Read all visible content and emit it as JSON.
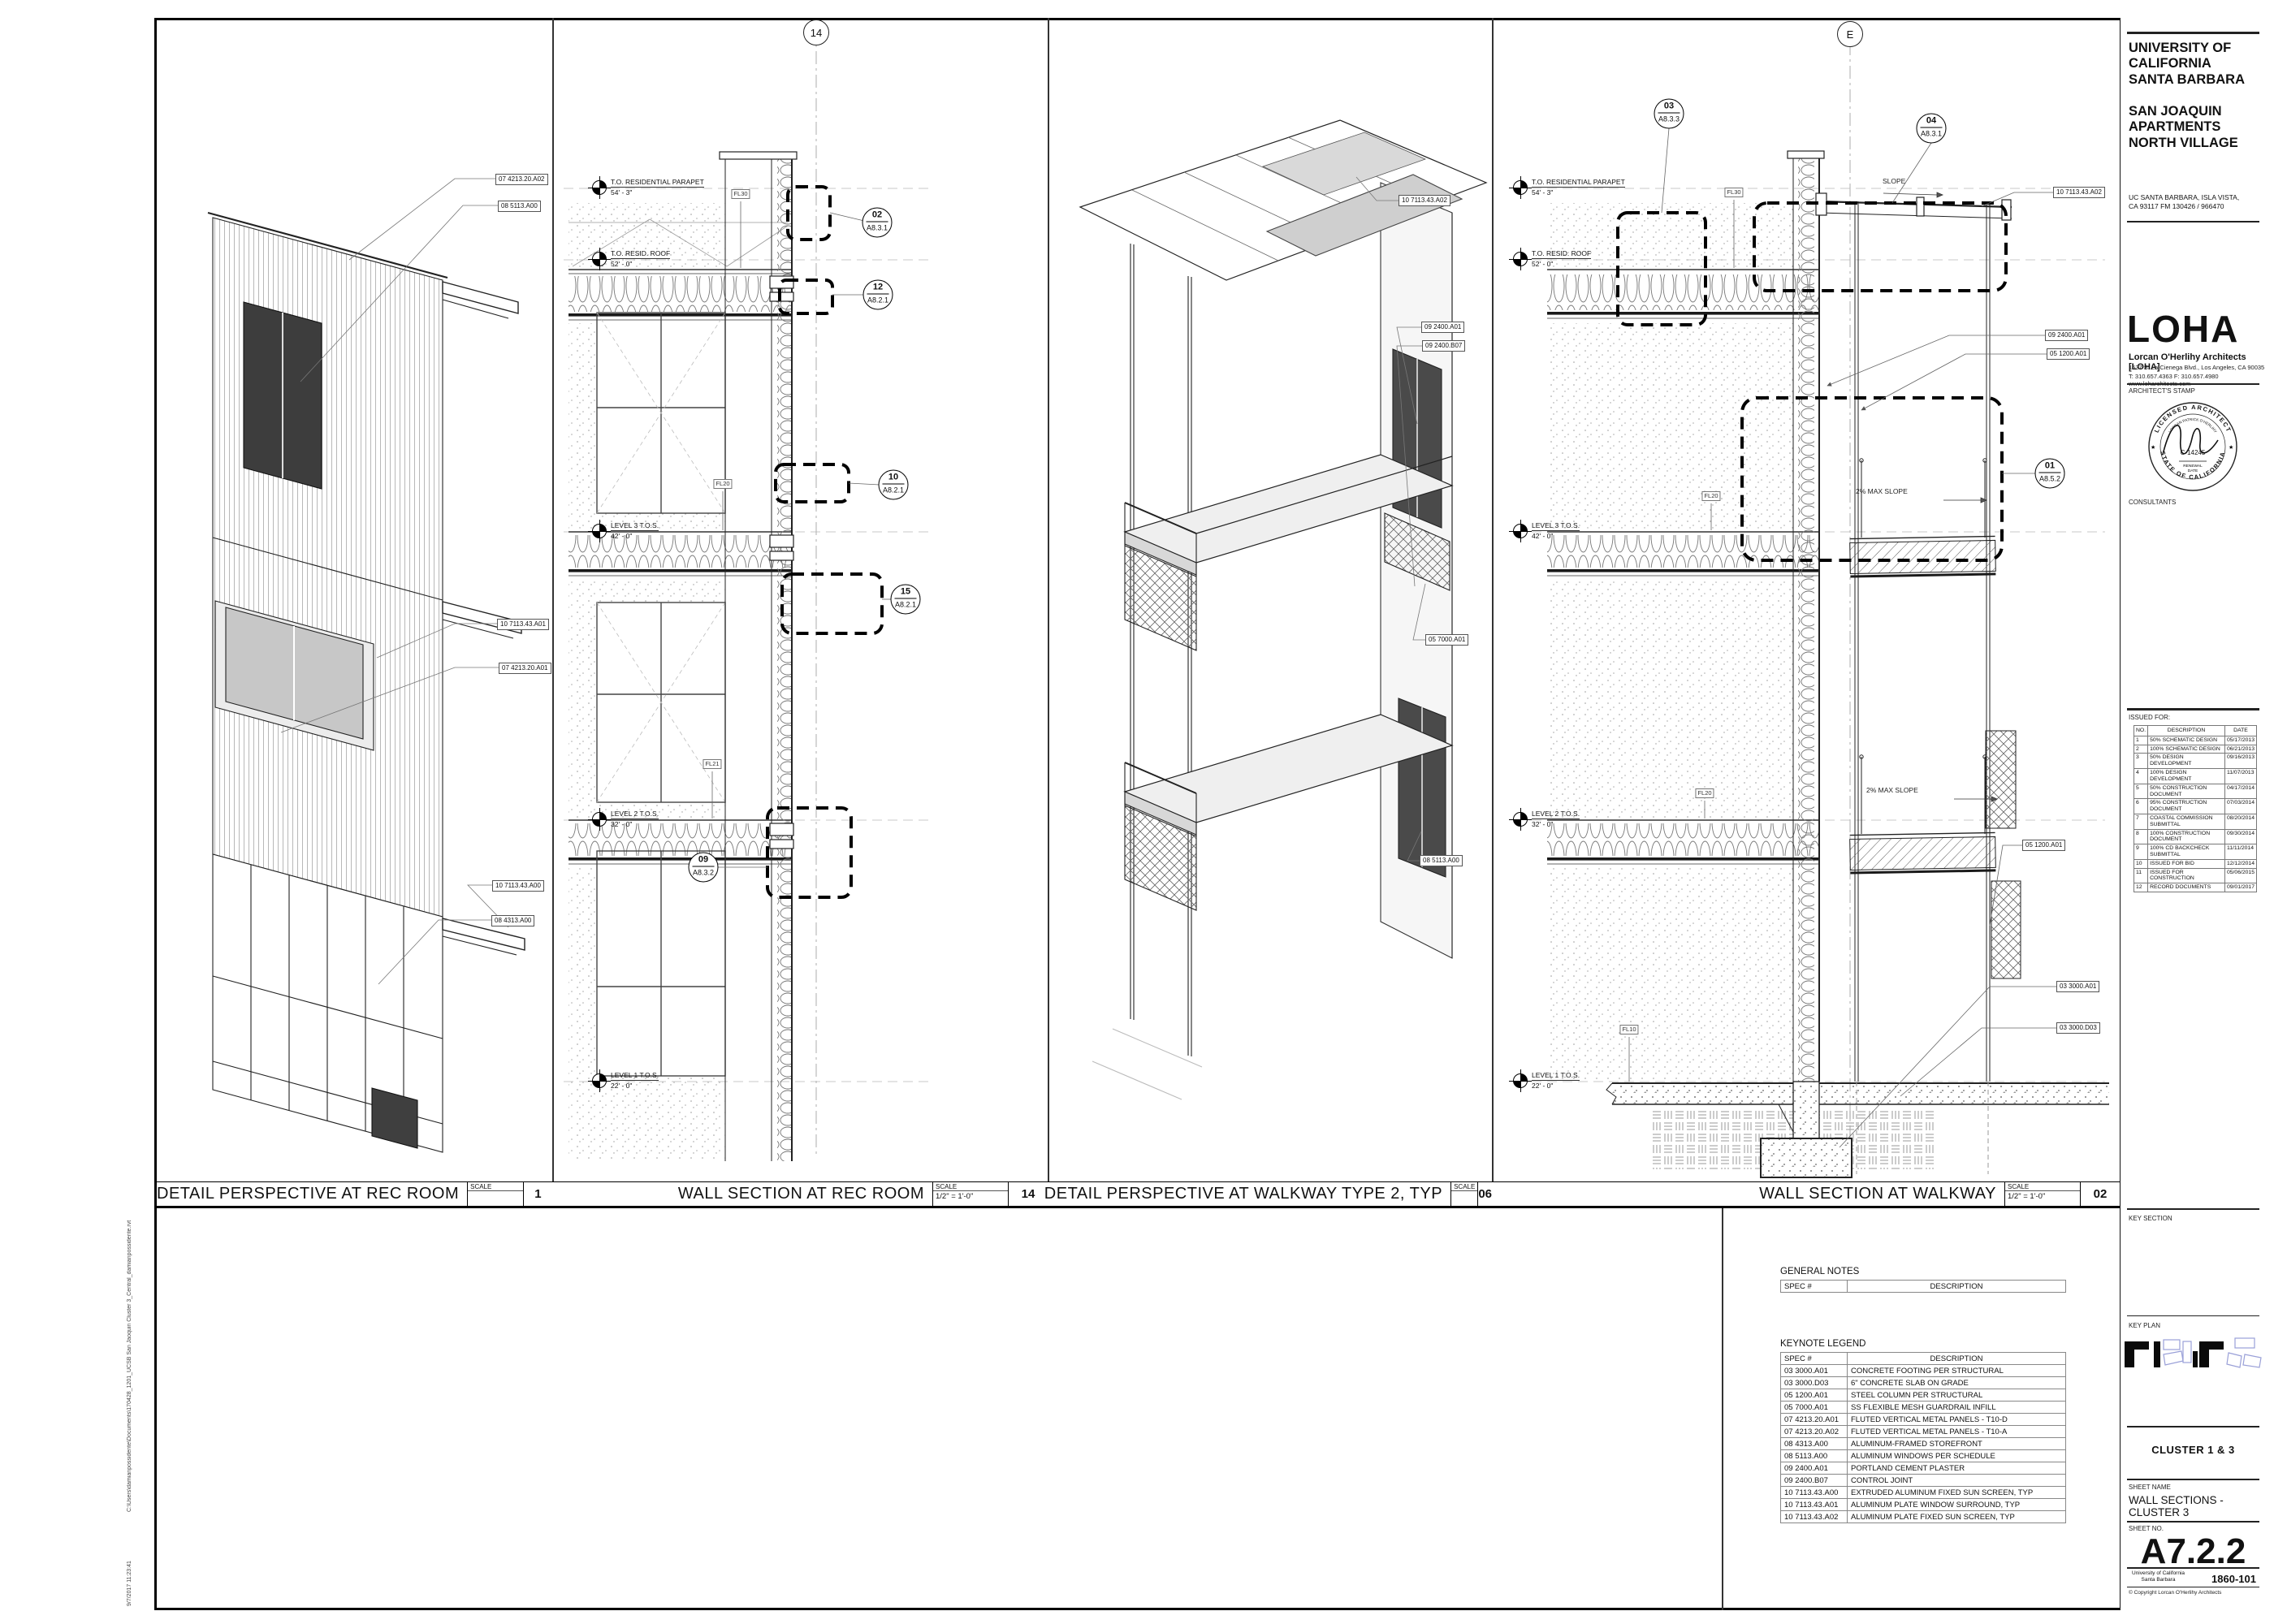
{
  "margin": {
    "path": "C:\\Users\\damianpossidente\\Documents\\170428_1201_UCSB San Jaoquin Cluster 3_Central_damianpossidente.rvt",
    "datetime": "9/7/2017 11:23:41"
  },
  "panels": {
    "p1": {
      "title": "DETAIL PERSPECTIVE  AT REC ROOM",
      "scale_label": "SCALE",
      "scale": "",
      "num": "1",
      "tags": [
        "07 4213.20.A02",
        "08 5113.A00",
        "10 7113.43.A01",
        "07 4213.20.A01",
        "10 7113.43.A00",
        "08 4313.A00"
      ]
    },
    "p2": {
      "title": "WALL SECTION AT REC ROOM",
      "scale_label": "SCALE",
      "scale": "1/2\" = 1'-0\"",
      "num": "14",
      "grid": "14",
      "levels": [
        {
          "name": "T.O. RESIDENTIAL PARAPET",
          "elev": "54' - 3\""
        },
        {
          "name": "T.O. RESID. ROOF",
          "elev": "52' - 0\""
        },
        {
          "name": "LEVEL 3 T.O.S.",
          "elev": "42' - 0\""
        },
        {
          "name": "LEVEL 2 T.O.S.",
          "elev": "32' - 0\""
        },
        {
          "name": "LEVEL 1 T.O.S.",
          "elev": "22' - 0\""
        }
      ],
      "callouts": [
        {
          "num": "02",
          "sht": "A8.3.1"
        },
        {
          "num": "12",
          "sht": "A8.2.1"
        },
        {
          "num": "10",
          "sht": "A8.2.1"
        },
        {
          "num": "15",
          "sht": "A8.2.1"
        },
        {
          "num": "09",
          "sht": "A8.3.2"
        }
      ],
      "fl": [
        "FL30",
        "FL20",
        "FL21"
      ]
    },
    "p3": {
      "title": "DETAIL PERSPECTIVE  AT WALKWAY TYPE 2, TYP",
      "scale_label": "SCALE",
      "scale": "",
      "num": "06",
      "tags": [
        "10 7113.43.A02",
        "09 2400.A01",
        "09 2400.B07",
        "05 7000.A01",
        "08 5113.A00"
      ]
    },
    "p4": {
      "title": "WALL SECTION AT WALKWAY",
      "scale_label": "SCALE",
      "scale": "1/2\" = 1'-0\"",
      "num": "02",
      "grid": "E",
      "levels": [
        {
          "name": "T.O. RESIDENTIAL PARAPET",
          "elev": "54' - 3\""
        },
        {
          "name": "T.O. RESID. ROOF",
          "elev": "52' - 0\""
        },
        {
          "name": "LEVEL 3 T.O.S.",
          "elev": "42' - 0\""
        },
        {
          "name": "LEVEL 2 T.O.S.",
          "elev": "32' - 0\""
        },
        {
          "name": "LEVEL 1 T.O.S.",
          "elev": "22' - 0\""
        }
      ],
      "callouts": [
        {
          "num": "03",
          "sht": "A8.3.3"
        },
        {
          "num": "04",
          "sht": "A8.3.1"
        },
        {
          "num": "01",
          "sht": "A8.5.2"
        }
      ],
      "tags": [
        "10 7113.43.A02",
        "09 2400.A01",
        "05 1200.A01",
        "05 1200.A01",
        "03 3000.A01",
        "03 3000.D03"
      ],
      "slopes": [
        "SLOPE",
        "2% MAX SLOPE",
        "2% MAX SLOPE"
      ],
      "fl": [
        "FL30",
        "FL20",
        "FL20",
        "FL10"
      ]
    }
  },
  "notes": {
    "general_label": "GENERAL NOTES",
    "keynote_label": "KEYNOTE LEGEND",
    "col_spec": "SPEC #",
    "col_desc": "DESCRIPTION",
    "keynotes": [
      [
        "03 3000.A01",
        "CONCRETE FOOTING PER STRUCTURAL"
      ],
      [
        "03 3000.D03",
        "6\" CONCRETE SLAB ON GRADE"
      ],
      [
        "05 1200.A01",
        "STEEL COLUMN PER STRUCTURAL"
      ],
      [
        "05 7000.A01",
        "SS FLEXIBLE MESH GUARDRAIL INFILL"
      ],
      [
        "07 4213.20.A01",
        "FLUTED VERTICAL METAL PANELS - T10-D"
      ],
      [
        "07 4213.20.A02",
        "FLUTED VERTICAL METAL PANELS - T10-A"
      ],
      [
        "08 4313.A00",
        "ALUMINUM-FRAMED STOREFRONT"
      ],
      [
        "08 5113.A00",
        "ALUMINUM WINDOWS PER SCHEDULE"
      ],
      [
        "09 2400.A01",
        "PORTLAND CEMENT PLASTER"
      ],
      [
        "09 2400.B07",
        "CONTROL JOINT"
      ],
      [
        "10 7113.43.A00",
        "EXTRUDED ALUMINUM FIXED SUN SCREEN, TYP"
      ],
      [
        "10 7113.43.A01",
        "ALUMINUM PLATE WINDOW SURROUND, TYP"
      ],
      [
        "10 7113.43.A02",
        "ALUMINUM PLATE FIXED SUN SCREEN, TYP"
      ]
    ]
  },
  "titleblock": {
    "client": "UNIVERSITY OF\nCALIFORNIA\nSANTA BARBARA",
    "project": "SAN JOAQUIN\nAPARTMENTS\nNORTH VILLAGE",
    "address": "UC SANTA BARBARA, ISLA VISTA,\nCA 93117 FM 130426 / 966470",
    "logo": "LOHA",
    "firm": "Lorcan O'Herlihy Architects [LOHA]",
    "firm_address": "1537 S. La Cienega Blvd., Los Angeles, CA  90035",
    "firm_contact": "T: 310.657.4363  F: 310.657.4980  www.loharchitects.com",
    "stamp_label": "ARCHITECT'S STAMP",
    "stamp_top": "LICENSED ARCHITECT",
    "stamp_bottom": "STATE OF CALIFORNIA",
    "stamp_name": "LORCAN PATRICK O'HERLIHY",
    "stamp_lic": "C-14245",
    "stamp_renewal": "RENEWAL",
    "stamp_date": "DATE",
    "consultants_label": "CONSULTANTS",
    "issued_label": "ISSUED FOR:",
    "issued_cols": {
      "no": "NO.",
      "desc": "DESCRIPTION",
      "date": "DATE"
    },
    "issued": [
      [
        "1",
        "50% SCHEMATIC DESIGN",
        "05/17/2013"
      ],
      [
        "2",
        "100% SCHEMATIC DESIGN",
        "06/21/2013"
      ],
      [
        "3",
        "50% DESIGN DEVELOPMENT",
        "09/16/2013"
      ],
      [
        "4",
        "100% DESIGN DEVELOPMENT",
        "11/07/2013"
      ],
      [
        "5",
        "50% CONSTRUCTION DOCUMENT",
        "04/17/2014"
      ],
      [
        "6",
        "95% CONSTRUCTION DOCUMENT",
        "07/03/2014"
      ],
      [
        "7",
        "COASTAL COMMISSION SUBMITTAL",
        "08/20/2014"
      ],
      [
        "8",
        "100% CONSTRUCTION DOCUMENT",
        "09/30/2014"
      ],
      [
        "9",
        "100% CD BACKCHECK SUBMITTAL",
        "11/11/2014"
      ],
      [
        "10",
        "ISSUED FOR BID",
        "12/12/2014"
      ],
      [
        "11",
        "ISSUED FOR CONSTRUCTION",
        "05/06/2015"
      ],
      [
        "12",
        "RECORD DOCUMENTS",
        "09/01/2017"
      ]
    ],
    "key_section_label": "KEY SECTION",
    "key_plan_label": "KEY PLAN",
    "cluster": "CLUSTER 1 & 3",
    "sheet_name_label": "SHEET NAME",
    "sheet_name": "WALL SECTIONS - CLUSTER 3",
    "sheet_no_label": "SHEET NO.",
    "sheet_no": "A7.2.2",
    "univ_footer": "University of California\nSanta Barbara",
    "project_no": "1860-101",
    "copyright": "© Copyright Lorcan O'Herlihy Architects"
  }
}
